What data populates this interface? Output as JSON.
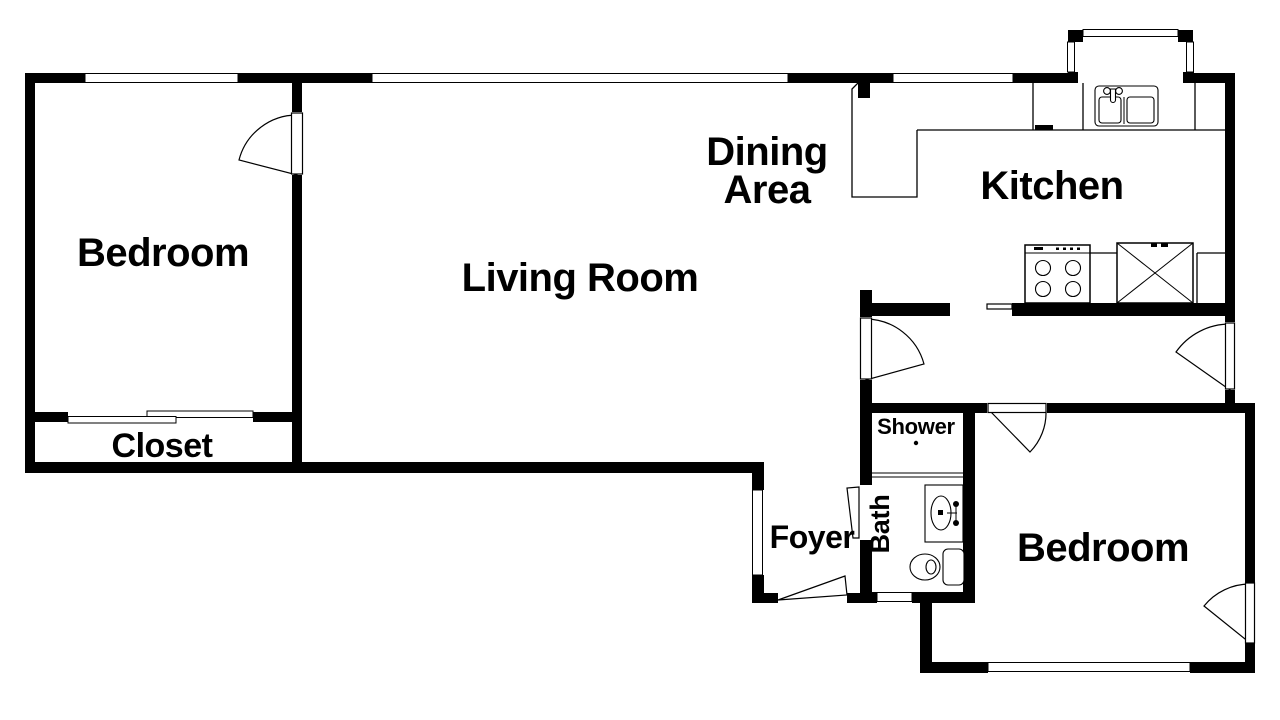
{
  "figure_type": "apartment-floor-plan",
  "colors": {
    "walls": "#000000",
    "background": "#ffffff",
    "text": "#000000"
  },
  "labels": {
    "bedroom_top": "Bedroom",
    "living_room": "Living Room",
    "dining_line1": "Dining",
    "dining_line2": "Area",
    "kitchen": "Kitchen",
    "closet": "Closet",
    "foyer": "Foyer",
    "shower": "Shower",
    "bath": "Bath",
    "bedroom_bottom": "Bedroom"
  },
  "rooms": [
    "Bedroom (top-left)",
    "Closet",
    "Living Room",
    "Dining Area",
    "Kitchen",
    "Hallway",
    "Foyer",
    "Shower",
    "Bath",
    "Bedroom (bottom-right)"
  ],
  "fixtures": [
    "kitchen-double-sink",
    "dishwasher",
    "stove-four-burners",
    "refrigerator",
    "kitchen-counter",
    "bay-window",
    "bath-vanity-sink",
    "toilet",
    "shower-pan",
    "closet-sliding-doors"
  ],
  "doors": [
    "bedroom-top-door",
    "living-to-hall-door",
    "hall-exterior-door",
    "bedroom-bottom-hall-door",
    "bedroom-bottom-exterior-door",
    "bath-door",
    "entry-door",
    "kitchen-service-opening"
  ],
  "windows": [
    "bedroom-top-window",
    "living-room-window",
    "kitchen-window",
    "bay-window-glazing",
    "foyer-window",
    "bath-window",
    "bedroom-bottom-window"
  ]
}
